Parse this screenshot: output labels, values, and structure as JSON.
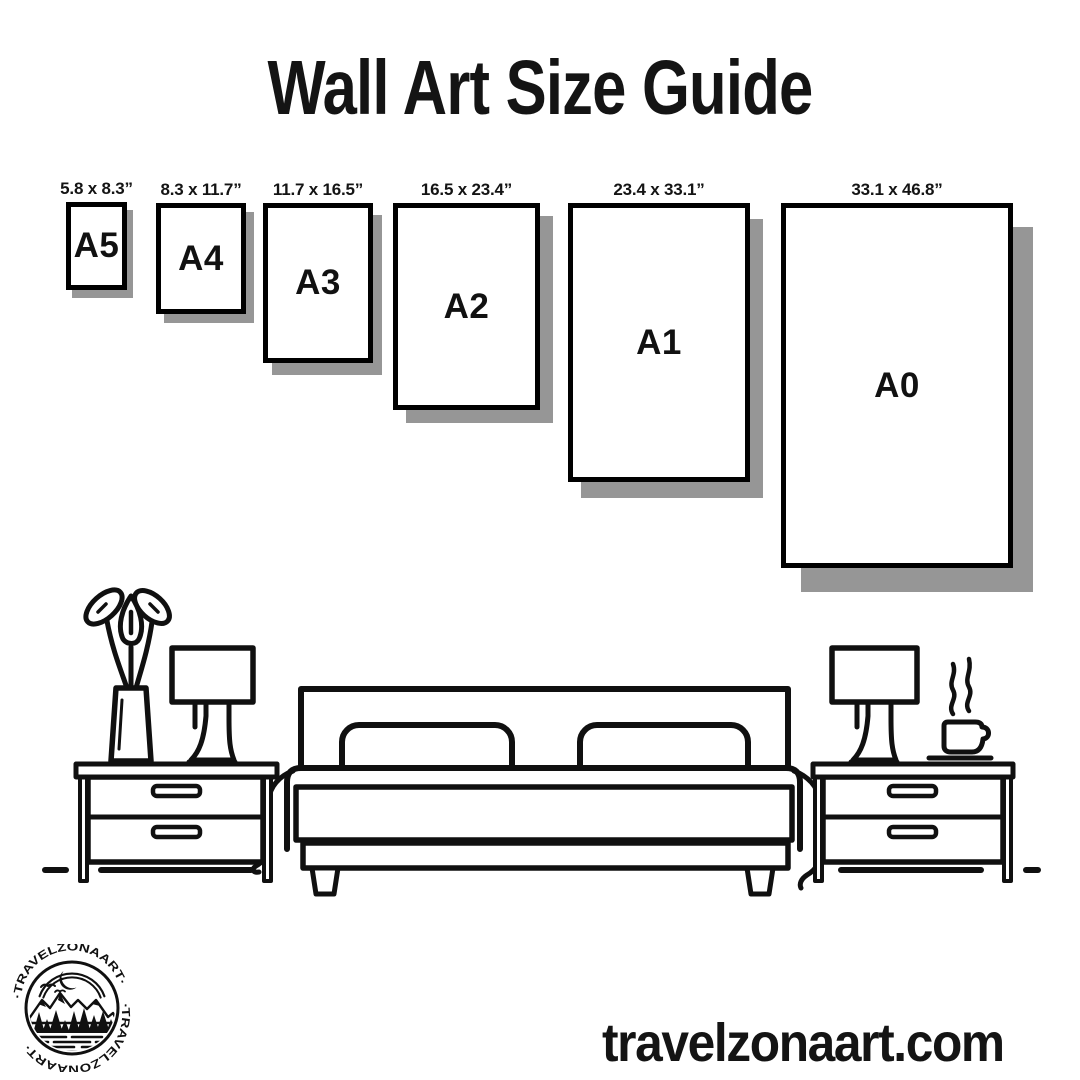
{
  "title": "Wall Art Size Guide",
  "frames": [
    {
      "code": "A5",
      "dimensions": "5.8 x 8.3”"
    },
    {
      "code": "A4",
      "dimensions": "8.3 x 11.7”"
    },
    {
      "code": "A3",
      "dimensions": "11.7 x 16.5”"
    },
    {
      "code": "A2",
      "dimensions": "16.5 x 23.4”"
    },
    {
      "code": "A1",
      "dimensions": "23.4 x 33.1”"
    },
    {
      "code": "A0",
      "dimensions": "33.1 x 46.8”"
    }
  ],
  "website": "travelzonaart.com",
  "logo": {
    "ring_text": "·TRAVELZONAART·"
  },
  "colors": {
    "ink": "#101010",
    "frame_border": "#000000",
    "shadow": "#969696",
    "background": "#ffffff"
  }
}
